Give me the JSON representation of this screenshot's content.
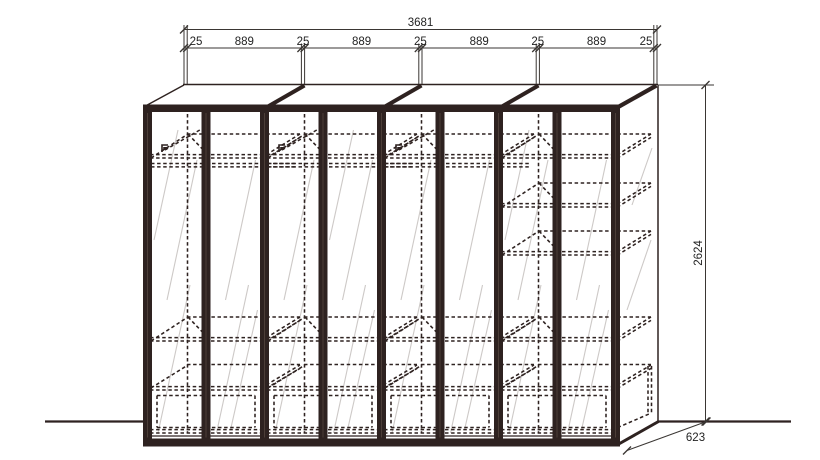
{
  "drawing": {
    "type": "wardrobe-elevation-technical-drawing",
    "dimensions": {
      "total_width": "3681",
      "segments": [
        "25",
        "889",
        "25",
        "889",
        "25",
        "889",
        "25",
        "889",
        "25"
      ],
      "height": "2624",
      "depth": "623"
    },
    "colors": {
      "line_dark": "#2e2220",
      "dimension_line": "#3a3633",
      "hatch": "#cdc9c7",
      "background": "#ffffff"
    }
  }
}
